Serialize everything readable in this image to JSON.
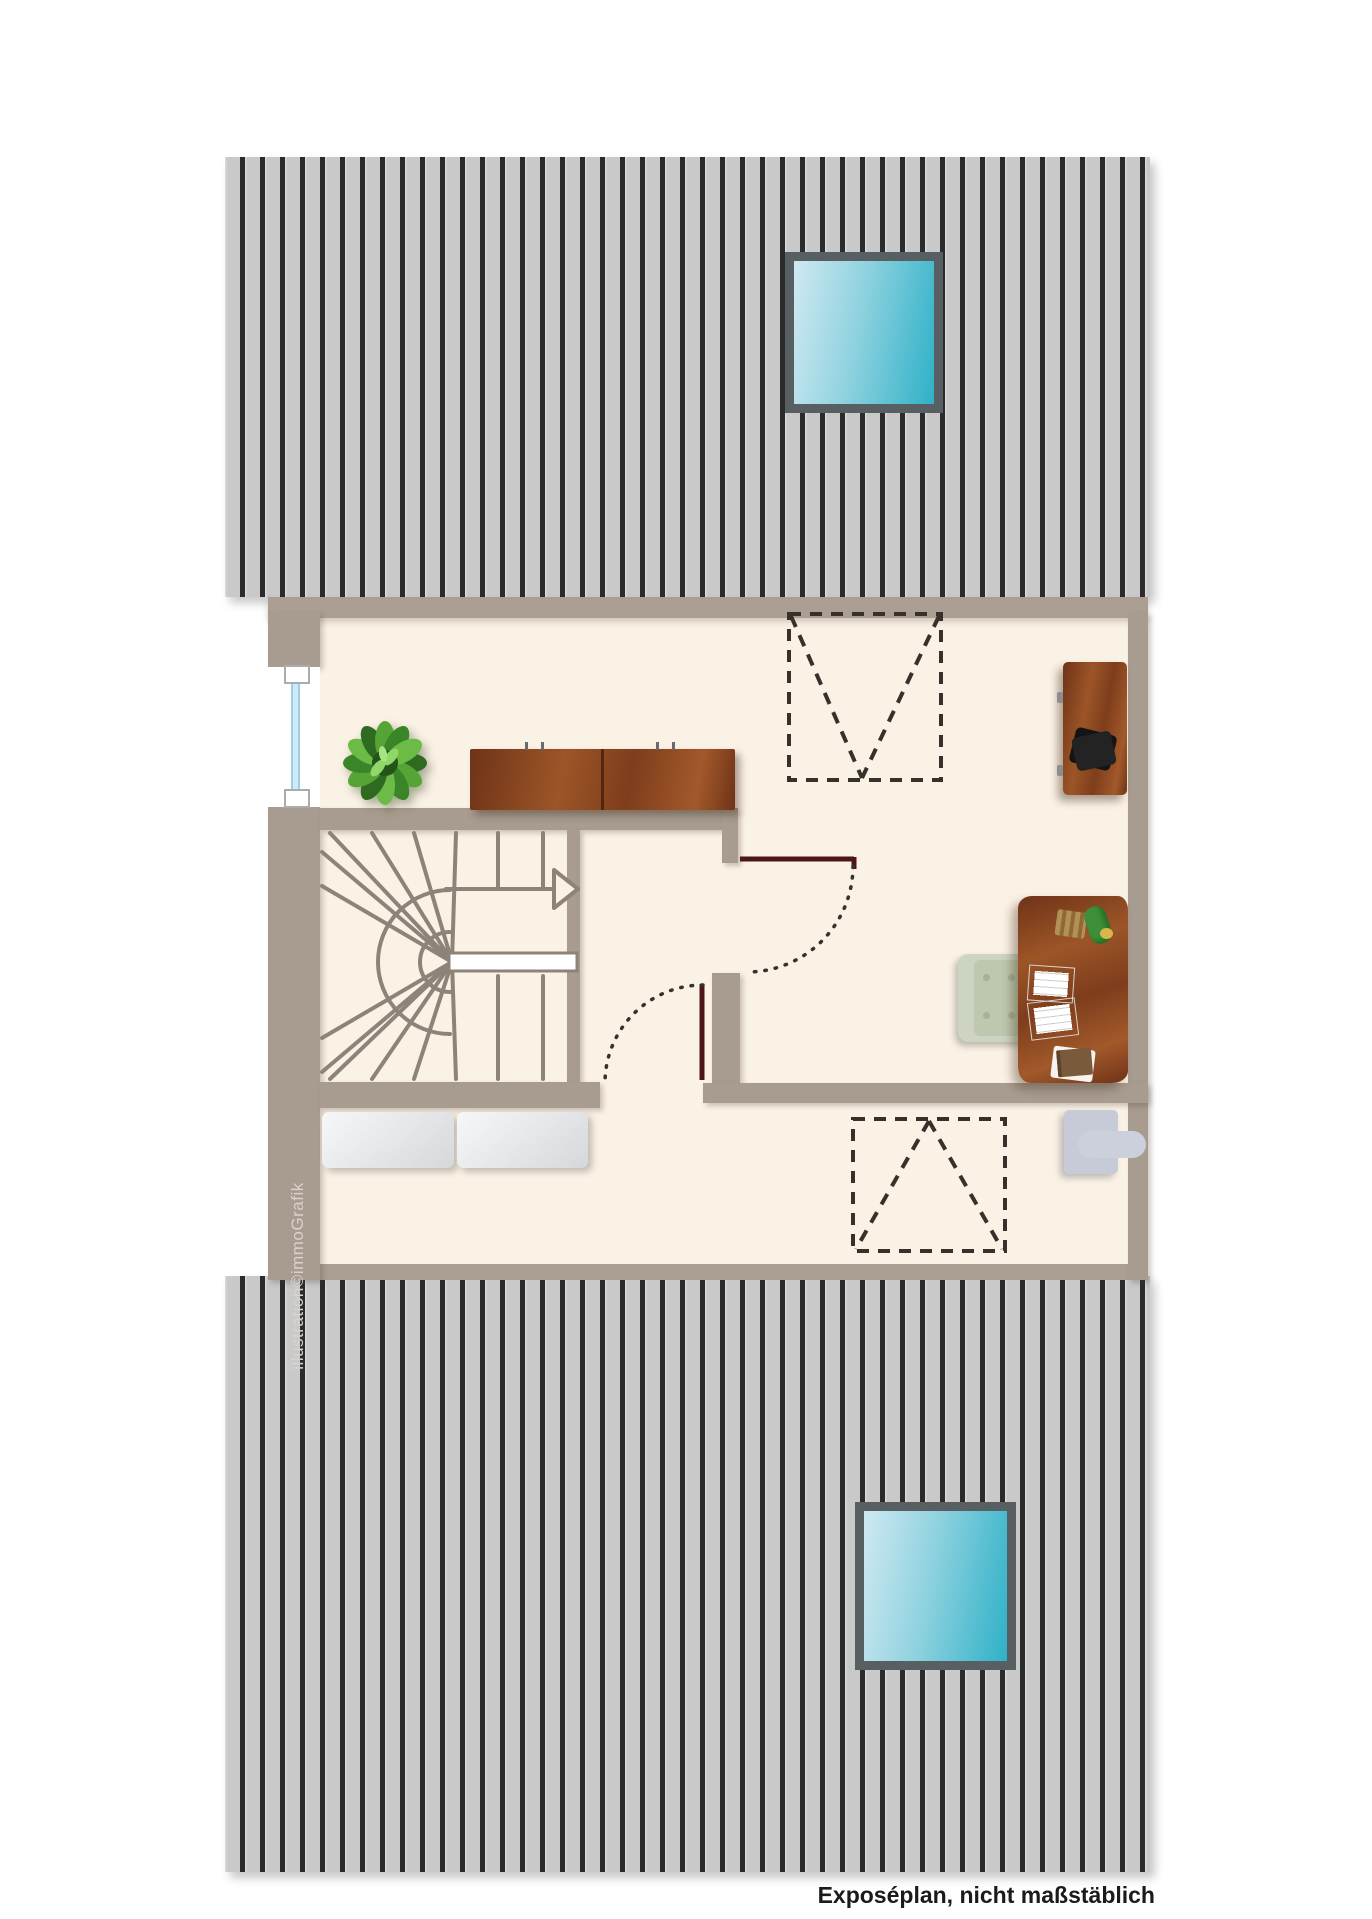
{
  "caption": "Exposéplan, nicht maßstäblich",
  "watermark": "illustration©immoGrafik",
  "palette": {
    "floor": "#fbf2e6",
    "wall_taupe": "#a89b8f",
    "roof_gray": "#c9c9c9",
    "roof_stripe": "#2b2b2b",
    "skylight_teal": "#2fb1c8",
    "skylight_light": "#cfe9f2",
    "door_red": "#4b151a",
    "dash_dark": "#38302a",
    "stair_line_gray": "#8d8379",
    "wood_brown": "#8a4a26",
    "sofa_gray": "#e4e6e8",
    "chair_sage": "#c6cfba",
    "radiator_gray": "#c9cdd8",
    "plant_green": "#4e9c33"
  },
  "elements": {
    "roof_top": "roof-surface-with-skylight",
    "roof_bottom": "roof-surface-with-skylight",
    "skylights": 2,
    "roof_window_projections": 2,
    "stair": "winder-staircase-with-up-arrow",
    "doors": 2,
    "window": "left-wall-window",
    "furniture": [
      "plant",
      "sideboard",
      "cabinet",
      "desk",
      "office-chair",
      "papers",
      "sofa",
      "radiator"
    ]
  }
}
